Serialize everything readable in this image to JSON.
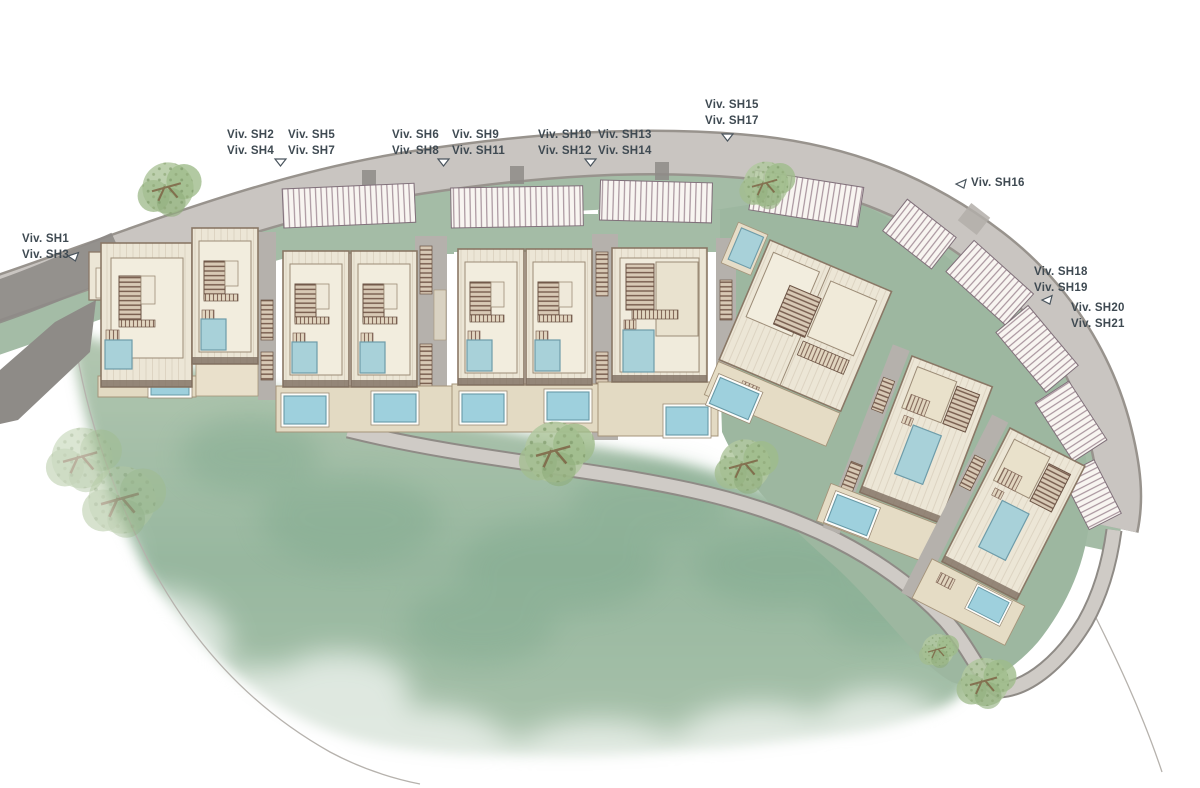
{
  "plan": {
    "type": "residential-site-plan",
    "labels": {
      "sh1_3": {
        "line1": "Viv. SH1",
        "line2": "Viv. SH3"
      },
      "sh2_4": {
        "line1": "Viv. SH2",
        "line2": "Viv. SH4"
      },
      "sh5_7": {
        "line1": "Viv. SH5",
        "line2": "Viv. SH7"
      },
      "sh6_8": {
        "line1": "Viv. SH6",
        "line2": "Viv. SH8"
      },
      "sh9_11": {
        "line1": "Viv. SH9",
        "line2": "Viv. SH11"
      },
      "sh10_12": {
        "line1": "Viv. SH10",
        "line2": "Viv. SH12"
      },
      "sh13_14": {
        "line1": "Viv. SH13",
        "line2": "Viv. SH14"
      },
      "sh15_17": {
        "line1": "Viv. SH15",
        "line2": "Viv. SH17"
      },
      "sh16": {
        "line1": "Viv. SH16"
      },
      "sh18_19": {
        "line1": "Viv. SH18",
        "line2": "Viv. SH19"
      },
      "sh20_21": {
        "line1": "Viv. SH20",
        "line2": "Viv. SH21"
      }
    },
    "icons": {
      "entry_marker": "open-triangle-down",
      "plot_marker": "open-triangle-slanted"
    },
    "colors": {
      "label_text": "#3f4a52",
      "road": "#c9c5c1",
      "road_dark": "#8e8b87",
      "path": "#cfcbc6",
      "garden_strip": "#a4bca6",
      "lawn": "#a6bfa8",
      "roof": "#ece6d6",
      "roof_edge": "#8a7866",
      "terrace": "#e3dac3",
      "pool": "#a8d1d9",
      "pool_bright": "#9ed0dd",
      "pergola_line": "#a18b95",
      "stair": "#7b6152",
      "tree": "#a9c29a"
    }
  }
}
